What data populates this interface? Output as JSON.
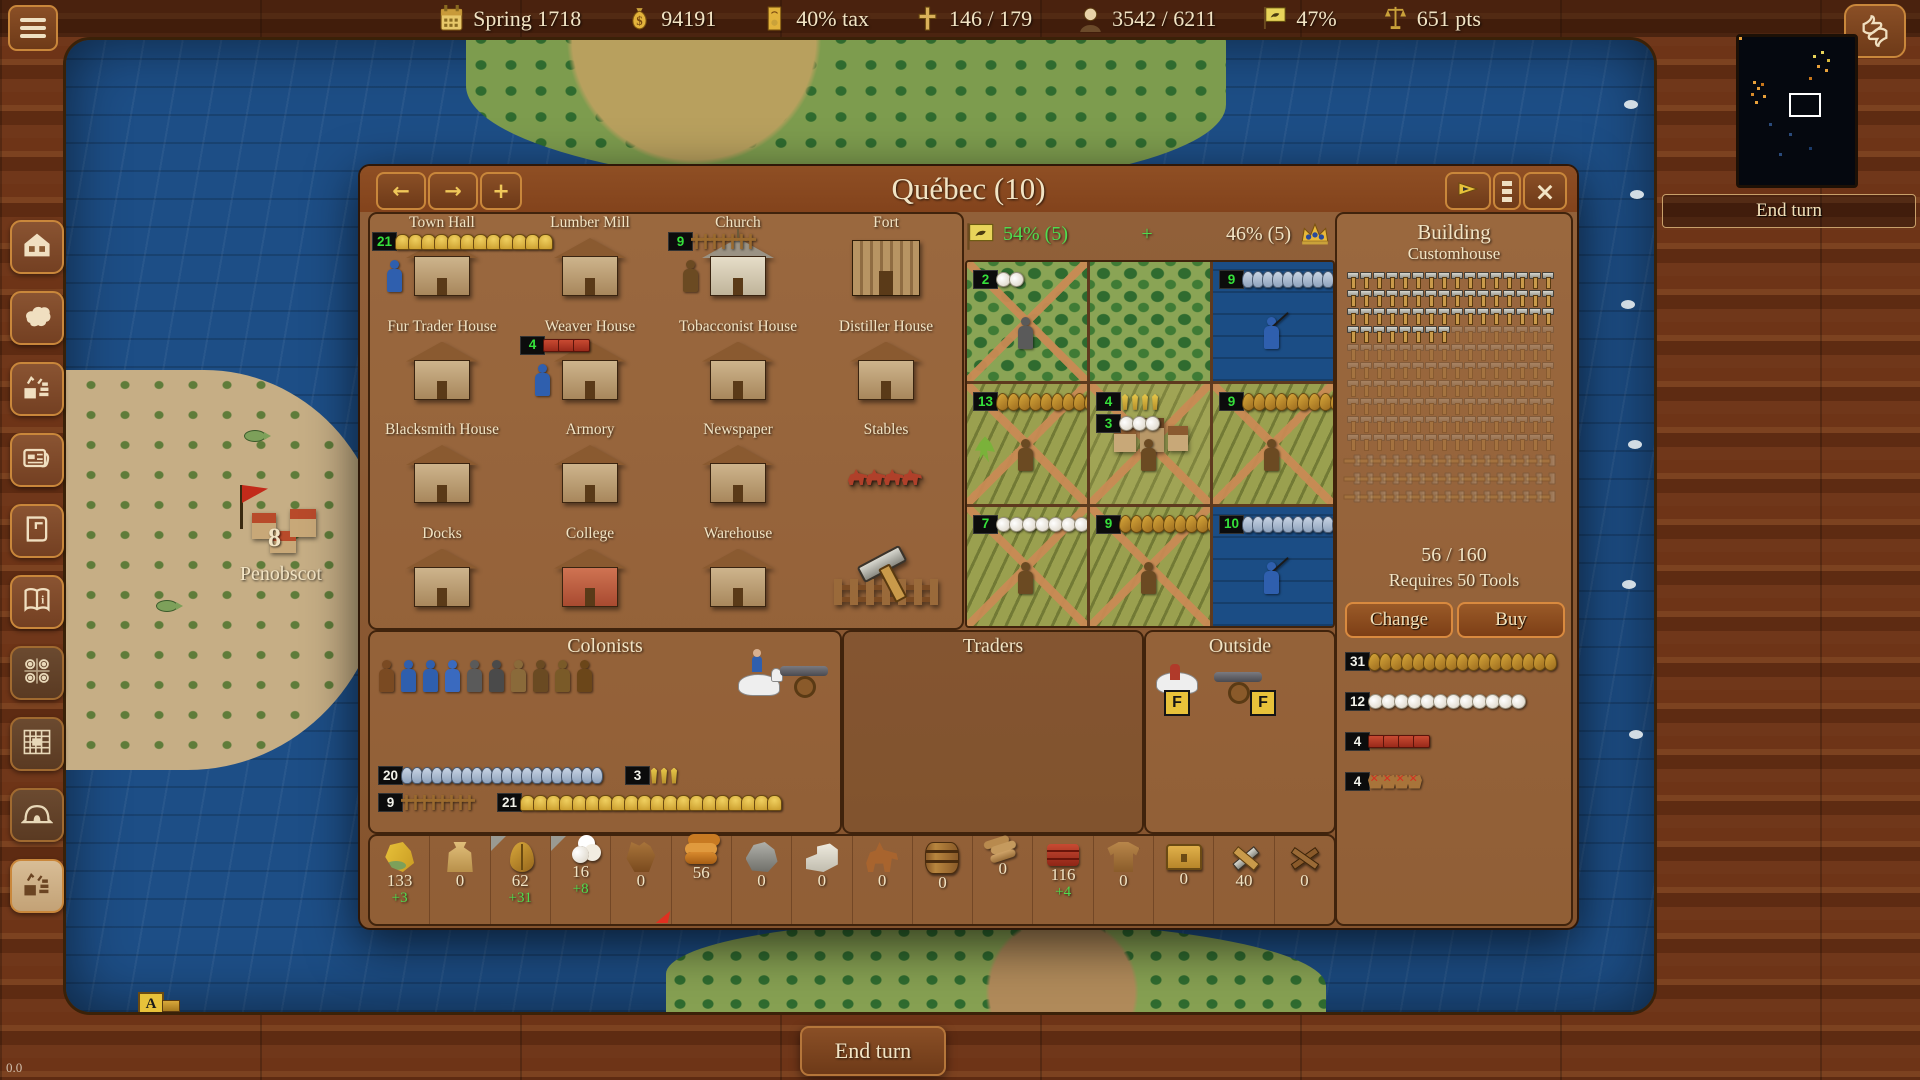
{
  "top_bar": {
    "date": "Spring 1718",
    "treasury": "94191",
    "tax": "40% tax",
    "crosses": "146 / 179",
    "population": "3542 / 6211",
    "liberty_pct": "47%",
    "score": "651 pts"
  },
  "glyphs": {
    "back": "←",
    "forward": "→",
    "split": "+",
    "close": "×",
    "plus": "+"
  },
  "sidebar": {
    "items": [
      {
        "icon": "house"
      },
      {
        "icon": "europe"
      },
      {
        "icon": "trade"
      },
      {
        "icon": "newspaper"
      },
      {
        "icon": "ledger"
      },
      {
        "icon": "info-book"
      },
      {
        "icon": "medals",
        "dim": true
      },
      {
        "icon": "fort-grid",
        "dim": true
      },
      {
        "icon": "hut",
        "dim": true
      },
      {
        "icon": "trade-alt",
        "light": true
      }
    ]
  },
  "map": {
    "penobscot_count": "8",
    "penobscot_label": "Penobscot",
    "marker": "A"
  },
  "end_turn": "End turn",
  "fps": "0.0",
  "dialog": {
    "title": "Québec (10)",
    "production": {
      "left": "54% (5)",
      "plus": "+",
      "right": "46% (5)"
    },
    "buildings": [
      {
        "name": "Town Hall",
        "variant": "house",
        "badge": "21",
        "strip": {
          "icon": "bell",
          "count": 12
        },
        "worker": "#2f5fae"
      },
      {
        "name": "Lumber Mill",
        "variant": "house"
      },
      {
        "name": "Church",
        "variant": "church",
        "badge": "9",
        "strip": {
          "icon": "cross",
          "count": 7
        },
        "worker": "#6b4a22"
      },
      {
        "name": "Fort",
        "variant": "fort"
      },
      {
        "name": "Fur Trader House",
        "variant": "house"
      },
      {
        "name": "Weaver House",
        "variant": "house",
        "badge": "4",
        "strip": {
          "icon": "clothsm",
          "count": 3
        },
        "worker": "#2f5fae"
      },
      {
        "name": "Tobacconist House",
        "variant": "house"
      },
      {
        "name": "Distiller House",
        "variant": "house"
      },
      {
        "name": "Blacksmith House",
        "variant": "house"
      },
      {
        "name": "Armory",
        "variant": "house"
      },
      {
        "name": "Newspaper",
        "variant": "house"
      },
      {
        "name": "Stables",
        "variant": "stables"
      },
      {
        "name": "Docks",
        "variant": "house"
      },
      {
        "name": "College",
        "variant": "college"
      },
      {
        "name": "Warehouse",
        "variant": "house"
      },
      {
        "name": "",
        "variant": "carpenter"
      }
    ],
    "tiles": [
      {
        "type": "forest",
        "roads": true,
        "badges": [
          {
            "n": "2",
            "icon": "cotton",
            "count": 2
          }
        ],
        "person": "#5a5a5a"
      },
      {
        "type": "forest",
        "roads": false,
        "badges": []
      },
      {
        "type": "water",
        "roads": false,
        "badges": [
          {
            "n": "9",
            "icon": "fish",
            "count": 9
          }
        ],
        "person": "fisher"
      },
      {
        "type": "field",
        "roads": true,
        "badges": [
          {
            "n": "13",
            "icon": "tobacco",
            "count": 10
          }
        ],
        "person": "#6b4a22",
        "plant": true
      },
      {
        "type": "city",
        "roads": true,
        "badges": [
          {
            "n": "4",
            "icon": "wheat",
            "count": 4
          },
          {
            "n": "3",
            "icon": "cotton",
            "count": 3
          }
        ],
        "person": "#6b4a22"
      },
      {
        "type": "field",
        "roads": true,
        "badges": [
          {
            "n": "9",
            "icon": "tobacco",
            "count": 9
          }
        ],
        "person": "#6b4a22"
      },
      {
        "type": "field",
        "roads": true,
        "badges": [
          {
            "n": "7",
            "icon": "cotton",
            "count": 7
          }
        ],
        "person": "#6b4a22"
      },
      {
        "type": "field",
        "roads": true,
        "badges": [
          {
            "n": "9",
            "icon": "tobacco",
            "count": 9
          }
        ],
        "person": "#6b4a22"
      },
      {
        "type": "water",
        "roads": false,
        "badges": [
          {
            "n": "10",
            "icon": "fish",
            "count": 10
          }
        ],
        "person": "fisher"
      }
    ],
    "build": {
      "header": "Building",
      "name": "Customhouse",
      "hammers_done": 56,
      "hammers_total": 160,
      "tools_shown": 48,
      "progress": "56 / 160",
      "requires": "Requires 50 Tools",
      "change_label": "Change",
      "buy_label": "Buy",
      "stock": [
        {
          "badge": "31",
          "icon": "tobacco",
          "count": 17
        },
        {
          "badge": "12",
          "icon": "cotton",
          "count": 12
        },
        {
          "badge": "4",
          "icon": "clothsm",
          "count": 4
        },
        {
          "badge": "4",
          "icon": "hide",
          "count": 4
        }
      ]
    },
    "colonists": {
      "title": "Colonists",
      "figures": [
        "#7a4a22",
        "#2f5fae",
        "#2f5fae",
        "#3a6abf",
        "#5a5a5a",
        "#4a4a4a",
        "#8a6a3a",
        "#6a4a22",
        "#7a5a28",
        "#6b4619"
      ],
      "stats": [
        [
          {
            "badge": "20",
            "icon": "fish",
            "count": 20
          },
          {
            "badge": "3",
            "icon": "wheat",
            "count": 3
          }
        ],
        [
          {
            "badge": "9",
            "icon": "cross",
            "count": 8
          },
          {
            "badge": "21",
            "icon": "bell",
            "count": 20
          }
        ]
      ]
    },
    "traders": {
      "title": "Traders"
    },
    "outside": {
      "title": "Outside",
      "flag_label": "F"
    },
    "resources": [
      {
        "name": "food",
        "value": "133",
        "delta": "+3"
      },
      {
        "name": "sugar",
        "value": "0"
      },
      {
        "name": "tobacco",
        "value": "62",
        "delta": "+31",
        "corner": true
      },
      {
        "name": "cotton",
        "value": "16",
        "delta": "+8",
        "corner": true
      },
      {
        "name": "furs",
        "value": "0",
        "warn": true
      },
      {
        "name": "lumber",
        "value": "56"
      },
      {
        "name": "ore",
        "value": "0"
      },
      {
        "name": "silver",
        "value": "0"
      },
      {
        "name": "horses",
        "value": "0"
      },
      {
        "name": "rum",
        "value": "0"
      },
      {
        "name": "cigars",
        "value": "0"
      },
      {
        "name": "cloth",
        "value": "116",
        "delta": "+4"
      },
      {
        "name": "coats",
        "value": "0"
      },
      {
        "name": "goods",
        "value": "0"
      },
      {
        "name": "tools",
        "value": "40"
      },
      {
        "name": "muskets",
        "value": "0"
      }
    ]
  }
}
